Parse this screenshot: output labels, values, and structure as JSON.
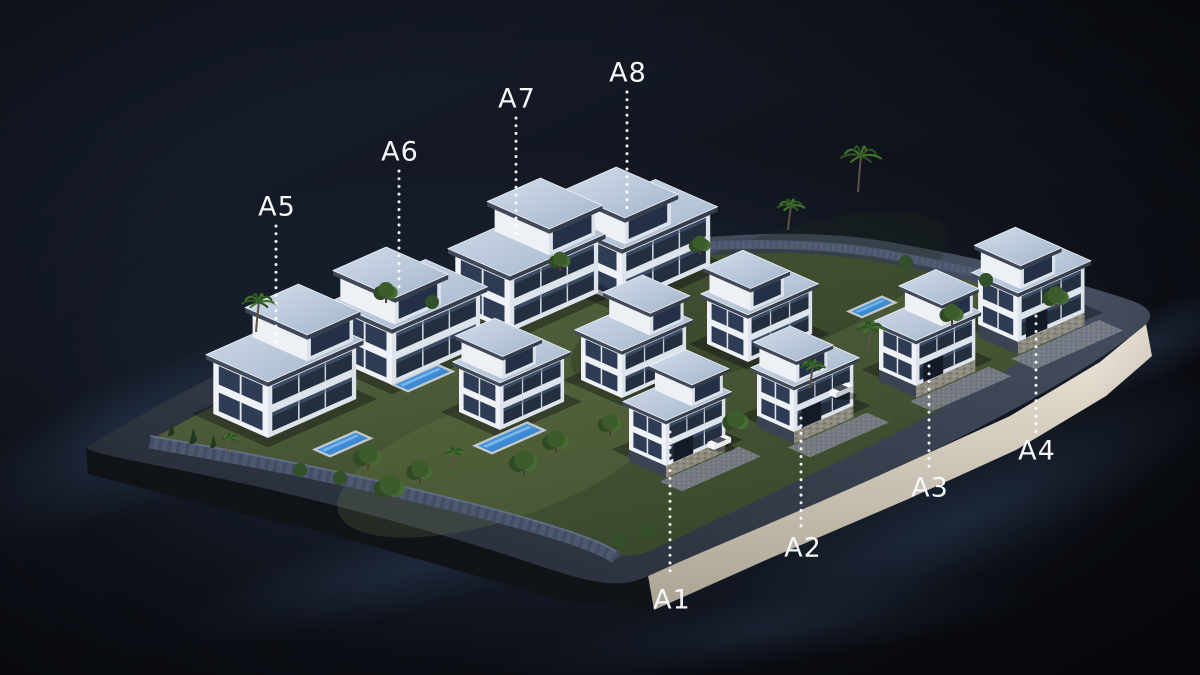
{
  "labels": [
    {
      "id": "a1",
      "text": "A1",
      "x": 672,
      "y": 601,
      "line_x": 670,
      "line_y1": 432,
      "line_y2": 576
    },
    {
      "id": "a2",
      "text": "A2",
      "x": 803,
      "y": 549,
      "line_x": 801,
      "line_y1": 418,
      "line_y2": 526
    },
    {
      "id": "a3",
      "text": "A3",
      "x": 930,
      "y": 489,
      "line_x": 929,
      "line_y1": 366,
      "line_y2": 468
    },
    {
      "id": "a4",
      "text": "A4",
      "x": 1037,
      "y": 452,
      "line_x": 1036,
      "line_y1": 316,
      "line_y2": 432
    },
    {
      "id": "a5",
      "text": "A5",
      "x": 277,
      "y": 208,
      "line_x": 276,
      "line_y1": 226,
      "line_y2": 344
    },
    {
      "id": "a6",
      "text": "A6",
      "x": 400,
      "y": 153,
      "line_x": 399,
      "line_y1": 171,
      "line_y2": 290
    },
    {
      "id": "a7",
      "text": "A7",
      "x": 517,
      "y": 100,
      "line_x": 516,
      "line_y1": 118,
      "line_y2": 238
    },
    {
      "id": "a8",
      "text": "A8",
      "x": 628,
      "y": 74,
      "line_x": 627,
      "line_y1": 92,
      "line_y2": 210
    }
  ],
  "palette": {
    "background_top": "#1a2232",
    "background_bottom": "#0a0c11",
    "label_text": "#f4f6f8",
    "leader_dots": "#ffffff",
    "facade_lit": "#eef1f6",
    "facade_shade": "#dde3eb",
    "fascia": "#363d4b",
    "roof_slab": "#c2cedd",
    "glass": "#232e3e",
    "pool_water": "#3886d4",
    "lawn": "#4f5e38",
    "road": "#343c4a",
    "plinth_face": "#e9e2d3",
    "stone_wall": "#4a5568"
  }
}
